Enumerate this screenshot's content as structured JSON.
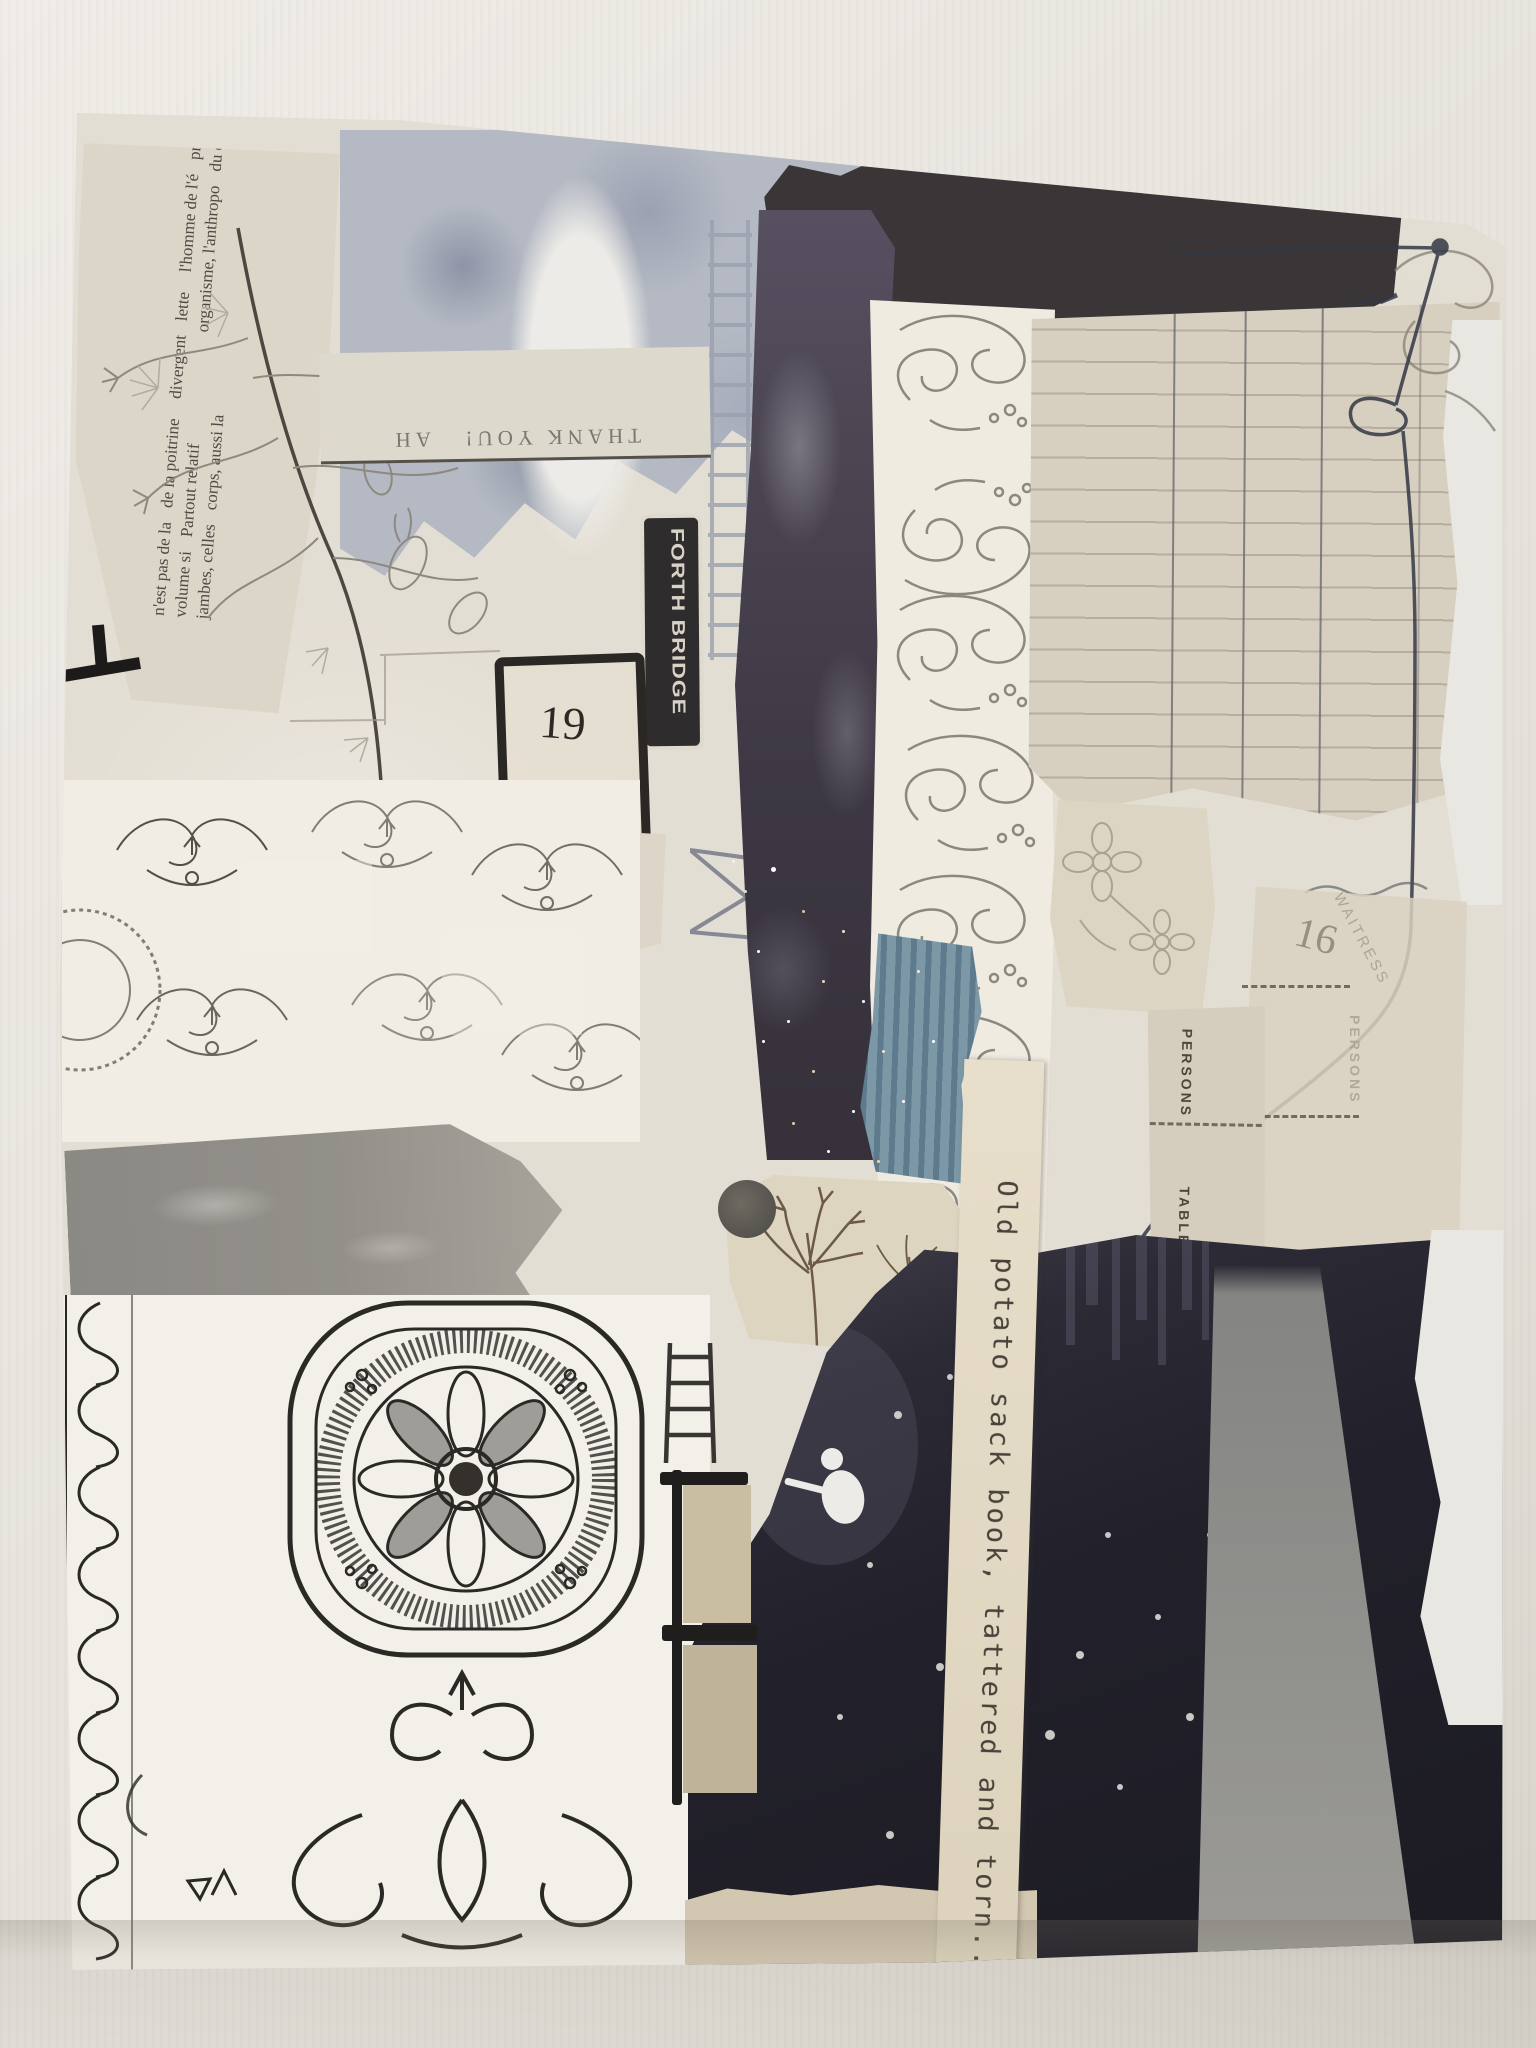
{
  "artwork": {
    "title_phrase": "Old potato sack book, tattered and torn...",
    "labels": {
      "forth_bridge": "FORTH BRIDGE",
      "thank_you": "THANK YOU!",
      "thank_you_partial": "AH",
      "waitress": "WAITRESS",
      "waitress_faded": "WAITRESS",
      "persons": "PERSONS",
      "table": "TABLE",
      "persons_faded": "PERSONS",
      "number_19": "19",
      "number_16": "16"
    },
    "newspaper": {
      "lines": [
        "n'est pas de la",
        "de la poitrine",
        "divergent",
        "lette",
        "l'homme de l'é",
        "profondes, et",
        "volume si",
        "Partout relatif",
        "organisme, l'anthropo",
        "du cœur et des",
        "jambes, celles",
        "corps, aussi la"
      ]
    },
    "colors": {
      "wall": "#e9e6e0",
      "board": "#e3ded3",
      "charcoal_band": "#3a3637",
      "purple_strip": "#4a4450",
      "dark_mass": "#21202a",
      "ledger_paper": "#d7cfbf",
      "gray_band": "#8f8d86",
      "blue_corrugated": "#6f8da0",
      "tape": "#c9bda2",
      "label_black": "#2f2c2d"
    }
  }
}
